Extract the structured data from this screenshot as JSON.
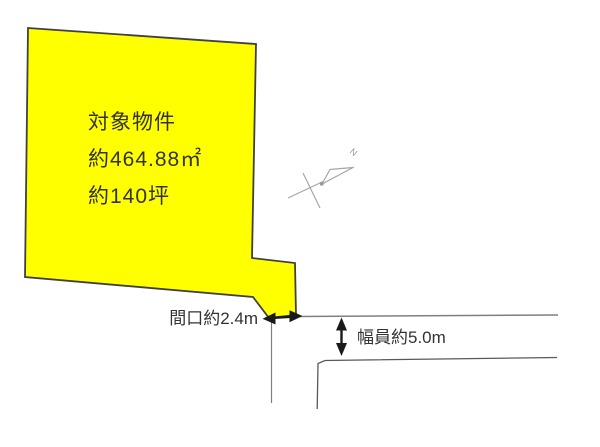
{
  "diagram": {
    "parcel": {
      "label_lines": [
        "対象物件",
        "約464.88㎡",
        "約140坪"
      ],
      "fill_color": "#FFFF00",
      "outline_color": "#404040"
    },
    "dimensions": {
      "frontage_label": "間口約2.4m",
      "frontage_value_m": 2.4,
      "road_width_label": "幅員約5.0m",
      "road_width_value_m": 5.0
    },
    "north_marker": {
      "label": "N"
    },
    "colors": {
      "dimension_arrow": "#1a1a1a",
      "road_line": "#7f7f7f",
      "road_line_dark": "#595959",
      "north_marker_line": "#a6a6a6",
      "text": "#333333"
    }
  }
}
